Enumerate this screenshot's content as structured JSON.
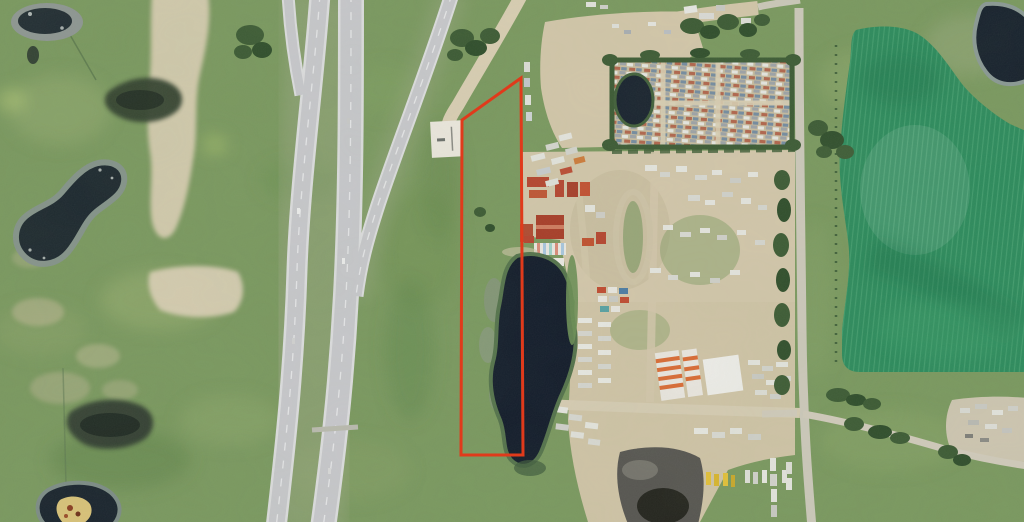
{
  "map": {
    "kind": "satellite-aerial-photo",
    "description": "Aerial/satellite view of a rural grassland parcel outlined in red, bounded by a divided highway and off-ramp on the west, an industrial storage and salvage yard on the east, a slough pond inside the parcel, and a large seeded crop field beside a north-south gravel road on the far east",
    "visible_text": [],
    "boundary": {
      "color": "#e03a1b",
      "width": "3",
      "points": "521,78 462,120 461,455 523,455"
    },
    "colors": {
      "grass": "#7a985f",
      "grass_light": "#9ab074",
      "grass_dark": "#5d8049",
      "verge": "#a3aa8c",
      "crop_field": "#2c8a5c",
      "crop_row": "#4aa273",
      "pond_dark": "#121b2a",
      "marsh": "#313e31",
      "rock_gray": "#8d9793",
      "road_paved": "#c7c7cb",
      "road_edge": "#dcdcde",
      "road_line": "#f0f0f2",
      "road_dirt": "#d8cdb2",
      "yard_dirt": "#d0c4a8",
      "hedge": "#3c5a34",
      "roof_red": "#b5432e",
      "roof_orange": "#d96b35",
      "building_white": "#eceae4",
      "gravel": "#565450",
      "gravel_dark": "#23231d",
      "truck_yellow": "#e3c038",
      "island_sand": "#d9c278"
    },
    "features": [
      "highway-interchange",
      "highway-onramp",
      "frontage-dirt-road",
      "staging-pad",
      "property-boundary",
      "grassland-parcel",
      "parcel-pond",
      "industrial-yard",
      "salvage-yard",
      "crop-field",
      "gravel-road",
      "left-ponds",
      "gravel-stockpile",
      "equipment-yard"
    ]
  }
}
